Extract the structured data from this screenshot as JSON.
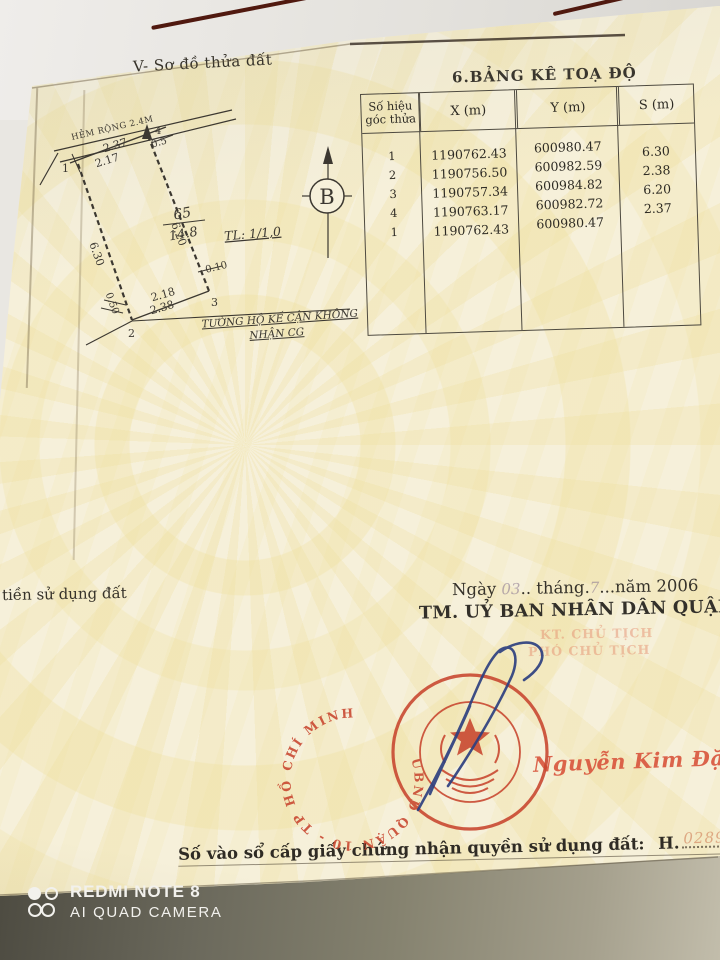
{
  "camera_watermark": {
    "line1": "REDMI NOTE 8",
    "line2": "AI QUAD CAMERA"
  },
  "document": {
    "map_section": {
      "title": "V- Sơ đồ thửa đất",
      "street_label": "HẺM RỘNG 2.4M",
      "scale": "TL: 1/1,0",
      "parcel_number": "65",
      "parcel_area": "14.8",
      "compass": "B",
      "vertex_1": "1",
      "vertex_2": "2",
      "vertex_3": "3",
      "vertex_4": "4",
      "measurements": {
        "top": "2.37",
        "top_inner": "2.17",
        "near_4": "0.5",
        "left_side": "6.30",
        "right_side": "6.20",
        "bottom_inner": "2.18",
        "bottom_outer": "2.38",
        "near_2": "0.50",
        "near_3": "0.10"
      },
      "wall_note_line1": "TƯỜNG HỘ KẾ CẬN KHÔNG",
      "wall_note_line2": "NHẬN CG"
    },
    "coords_table": {
      "title": "6.BẢNG KÊ TOẠ ĐỘ",
      "headers": [
        "Số hiệu góc thửa",
        "X (m)",
        "Y (m)",
        "S (m)"
      ],
      "rows": [
        [
          "1",
          "1190762.43",
          "600980.47",
          "6.30"
        ],
        [
          "2",
          "1190756.50",
          "600982.59",
          "2.38"
        ],
        [
          "3",
          "1190757.34",
          "600984.82",
          "6.20"
        ],
        [
          "4",
          "1190763.17",
          "600982.72",
          "2.37"
        ],
        [
          "1",
          "1190762.43",
          "600980.47",
          ""
        ]
      ]
    },
    "left_fragment": "tiền sử dụng đất",
    "issue": {
      "date_ngay": "Ngày ",
      "date_day": "03",
      "date_thang": ".. tháng.",
      "date_month": "7",
      "date_nam": "...năm 2006",
      "authority": "TM. UỶ BAN NHÂN DÂN QUẬN 10",
      "faded_line1": "KT. CHỦ TỊCH",
      "faded_line2": "PHÓ CHỦ TỊCH",
      "stamp_ring_text": "UBND QUẬN 10  -  TP HỒ CHÍ MINH",
      "signer": "Nguyễn Kim Đặng"
    },
    "registry": {
      "label": "Số vào sổ cấp giấy chứng nhận quyền sử dụng đất:",
      "prefix": "H.",
      "number": "02893/01"
    }
  }
}
